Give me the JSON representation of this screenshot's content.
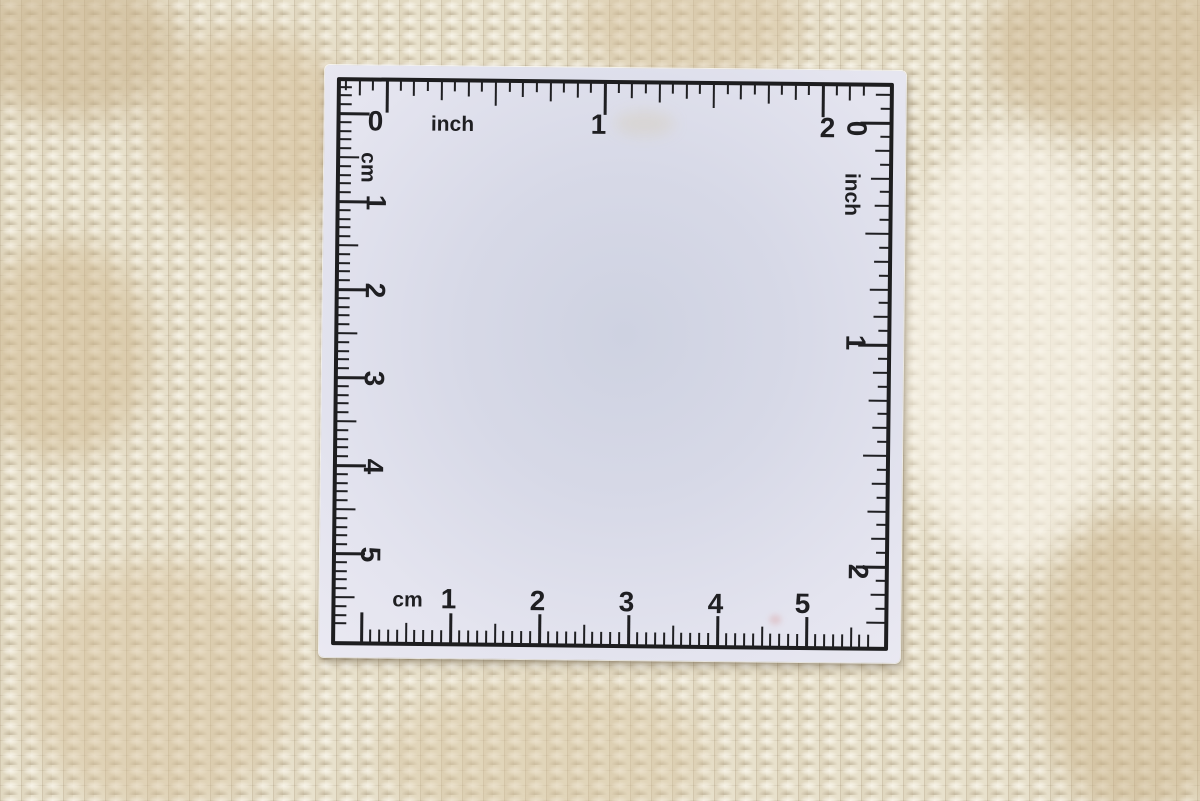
{
  "scene": {
    "description": "White square ruler card with inch and centimetre scales lying on a beige woven wool carpet",
    "colors": {
      "card": "#dfe0eb",
      "ink": "#1f1f22",
      "carpet_base": "#e7dfc9",
      "carpet_tan": "#c7ae86",
      "carpet_beige": "#d6c29c",
      "carpet_ivory": "#f4f0e4"
    }
  },
  "ruler": {
    "scales": [
      {
        "id": "top-inch-scale",
        "unit": "inch",
        "side": "top",
        "baseline": 15,
        "origin": 62,
        "px_per_unit": 218,
        "subdivisions": 16,
        "min": 21,
        "max": 546,
        "tick_lengths": {
          "unit": 32,
          "half": 24,
          "quarter": 19,
          "eighth": 15,
          "sixteenth": 10
        },
        "labels": [
          {
            "text": "0",
            "x": 51,
            "y": 56,
            "rot": 0,
            "size": 28
          },
          {
            "text": "inch",
            "x": 128,
            "y": 58,
            "rot": 0,
            "size": 21
          },
          {
            "text": "1",
            "x": 274,
            "y": 57,
            "rot": 0,
            "size": 28
          },
          {
            "text": "2",
            "x": 503,
            "y": 58,
            "rot": 0,
            "size": 28
          }
        ]
      },
      {
        "id": "right-inch-scale",
        "unit": "inch",
        "side": "right",
        "baseline": 15,
        "origin": 52,
        "px_per_unit": 222,
        "subdivisions": 16,
        "min": 21,
        "max": 558,
        "tick_lengths": {
          "unit": 30,
          "half": 24,
          "quarter": 19,
          "eighth": 15,
          "sixteenth": 10
        },
        "labels": [
          {
            "text": "0",
            "x": 532,
            "y": 58,
            "rot": 90,
            "size": 28
          },
          {
            "text": "inch",
            "x": 528,
            "y": 124,
            "rot": 90,
            "size": 21
          },
          {
            "text": "1",
            "x": 533,
            "y": 272,
            "rot": 90,
            "size": 28
          },
          {
            "text": "2",
            "x": 538,
            "y": 501,
            "rot": 90,
            "size": 28
          }
        ]
      },
      {
        "id": "left-cm-scale",
        "unit": "cm",
        "side": "left",
        "baseline": 15,
        "origin": 48,
        "px_per_unit": 88,
        "subdivisions": 10,
        "min": 21,
        "max": 560,
        "tick_lengths": {
          "unit": 30,
          "half": 20,
          "tenth": 12
        },
        "labels": [
          {
            "text": "cm",
            "x": 44,
            "y": 102,
            "rot": 90,
            "size": 21
          },
          {
            "text": "1",
            "x": 52,
            "y": 137,
            "rot": 90,
            "size": 28
          },
          {
            "text": "2",
            "x": 52,
            "y": 225,
            "rot": 90,
            "size": 28
          },
          {
            "text": "3",
            "x": 52,
            "y": 313,
            "rot": 90,
            "size": 28
          },
          {
            "text": "4",
            "x": 52,
            "y": 401,
            "rot": 90,
            "size": 28
          },
          {
            "text": "5",
            "x": 50,
            "y": 489,
            "rot": 90,
            "size": 28
          }
        ]
      },
      {
        "id": "bottom-cm-scale",
        "unit": "cm",
        "side": "bottom",
        "baseline": 15,
        "origin": 42,
        "px_per_unit": 89,
        "subdivisions": 10,
        "min": 40,
        "max": 554,
        "tick_lengths": {
          "unit": 30,
          "half": 20,
          "tenth": 13
        },
        "labels": [
          {
            "text": "cm",
            "x": 88,
            "y": 534,
            "rot": 0,
            "size": 21
          },
          {
            "text": "1",
            "x": 129,
            "y": 533,
            "rot": 0,
            "size": 28
          },
          {
            "text": "2",
            "x": 218,
            "y": 534,
            "rot": 0,
            "size": 28
          },
          {
            "text": "3",
            "x": 307,
            "y": 534,
            "rot": 0,
            "size": 28
          },
          {
            "text": "4",
            "x": 396,
            "y": 535,
            "rot": 0,
            "size": 28
          },
          {
            "text": "5",
            "x": 483,
            "y": 534,
            "rot": 0,
            "size": 28
          }
        ]
      }
    ]
  }
}
